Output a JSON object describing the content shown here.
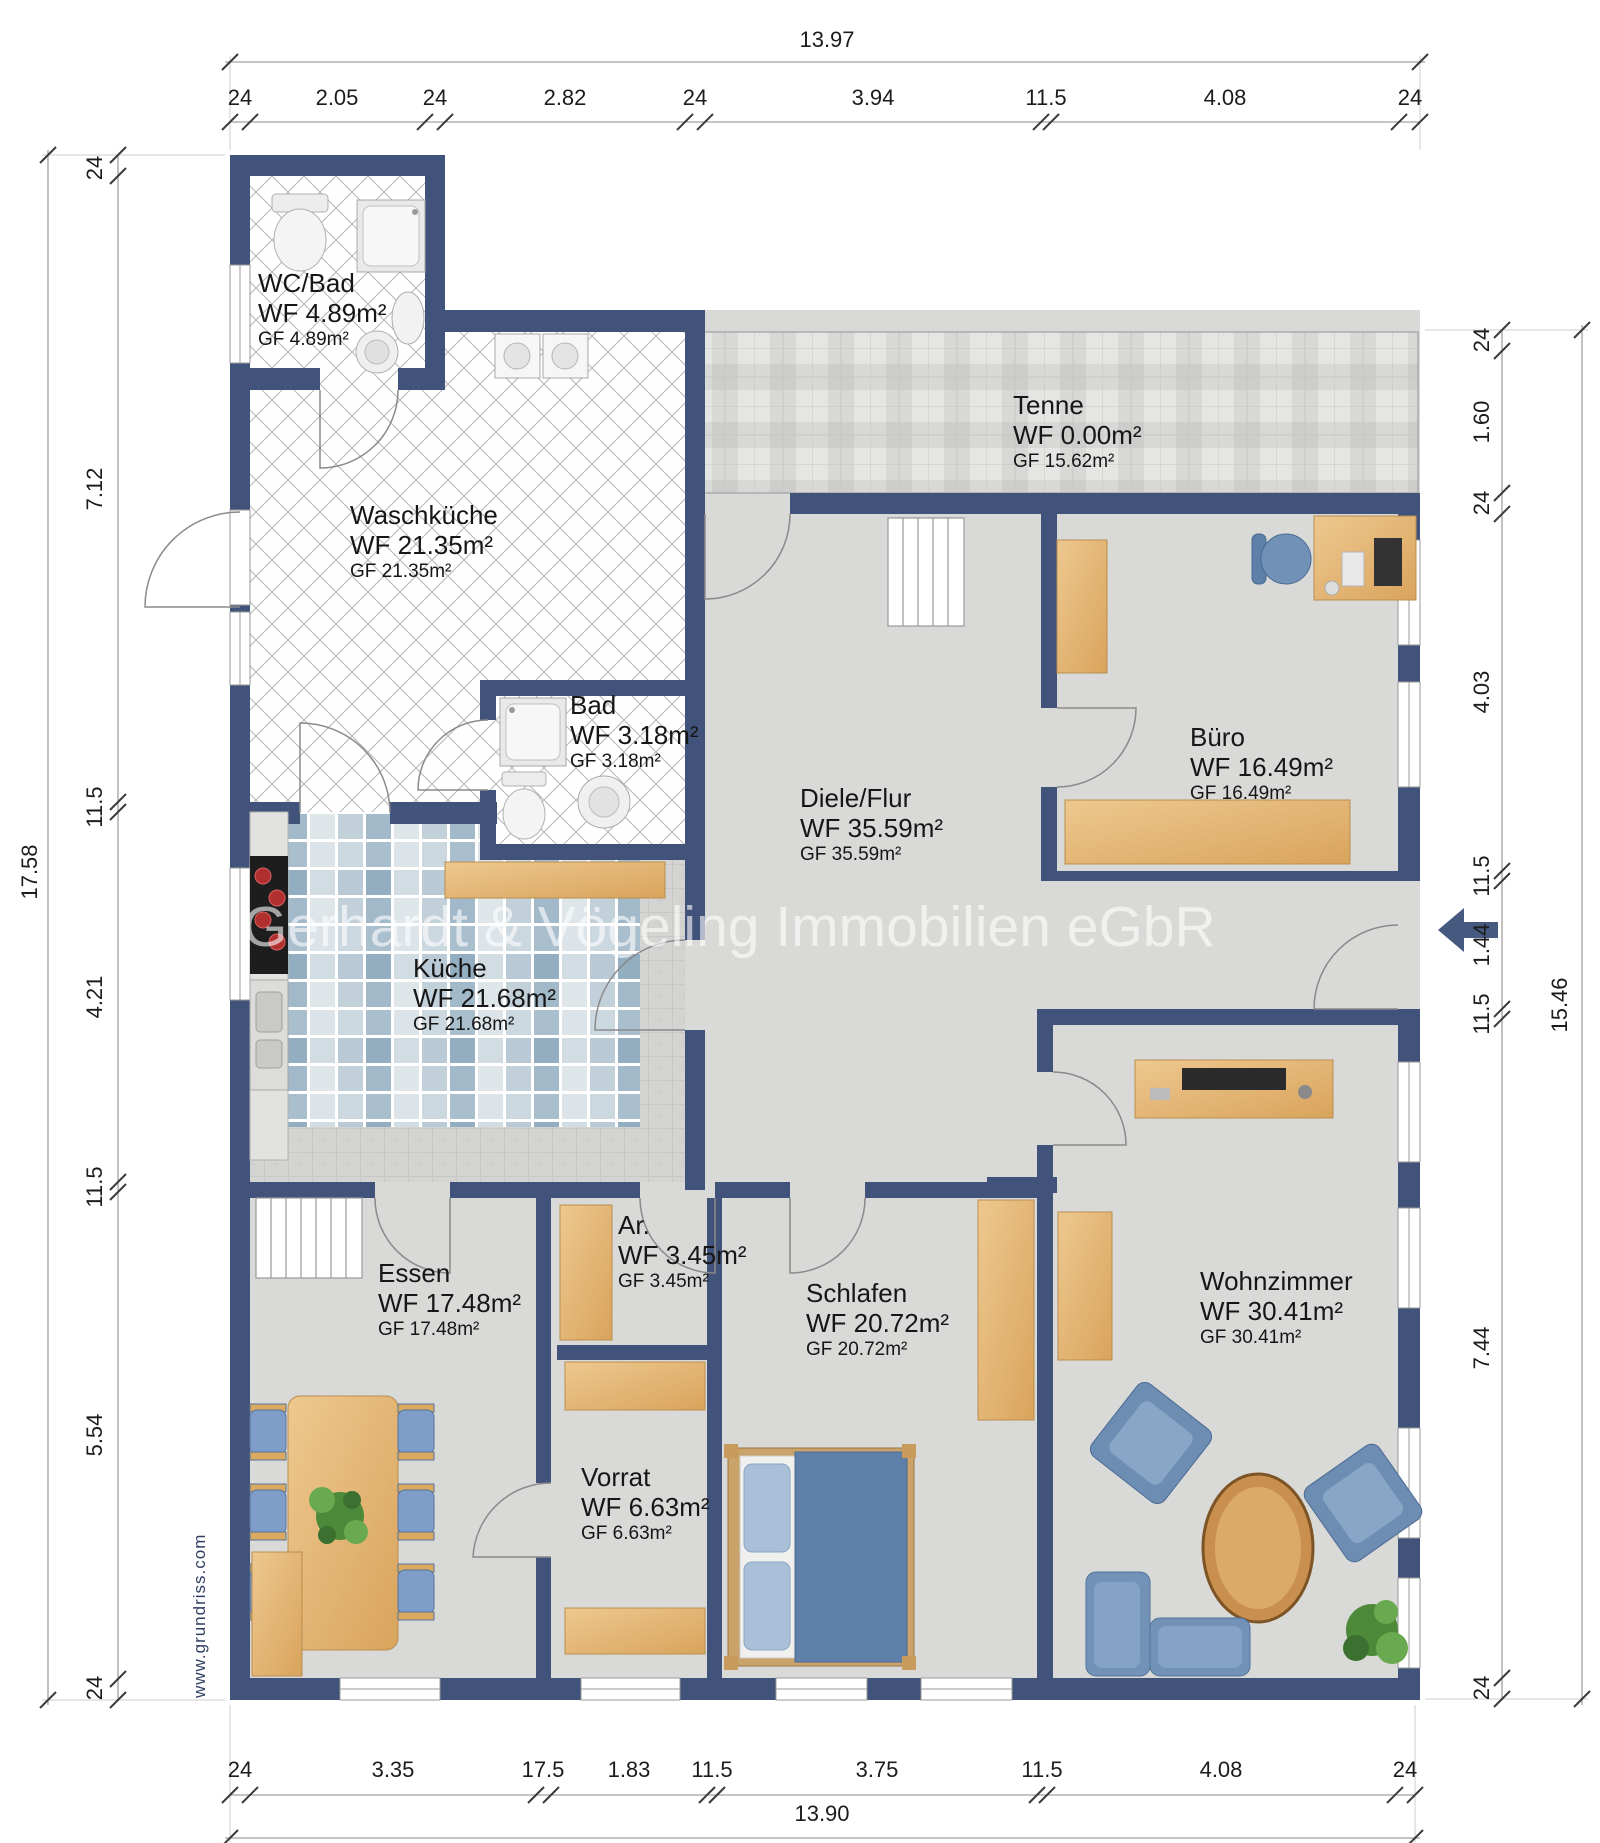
{
  "watermark": "Gerhardt & Vögeling Immobilien eGbR",
  "website_label": "www.grundriss.com",
  "rooms": {
    "wc_bad": {
      "name": "WC/Bad",
      "wf": "WF 4.89m²",
      "gf": "GF 4.89m²"
    },
    "waschkueche": {
      "name": "Waschküche",
      "wf": "WF 21.35m²",
      "gf": "GF 21.35m²"
    },
    "tenne": {
      "name": "Tenne",
      "wf": "WF 0.00m²",
      "gf": "GF 15.62m²"
    },
    "bad": {
      "name": "Bad",
      "wf": "WF 3.18m²",
      "gf": "GF 3.18m²"
    },
    "diele_flur": {
      "name": "Diele/Flur",
      "wf": "WF 35.59m²",
      "gf": "GF 35.59m²"
    },
    "buero": {
      "name": "Büro",
      "wf": "WF 16.49m²",
      "gf": "GF 16.49m²"
    },
    "kueche": {
      "name": "Küche",
      "wf": "WF 21.68m²",
      "gf": "GF 21.68m²"
    },
    "essen": {
      "name": "Essen",
      "wf": "WF 17.48m²",
      "gf": "GF 17.48m²"
    },
    "ar": {
      "name": "Ar.",
      "wf": "WF 3.45m²",
      "gf": "GF 3.45m²"
    },
    "vorrat": {
      "name": "Vorrat",
      "wf": "WF 6.63m²",
      "gf": "GF 6.63m²"
    },
    "schlafen": {
      "name": "Schlafen",
      "wf": "WF 20.72m²",
      "gf": "GF 20.72m²"
    },
    "wohnzimmer": {
      "name": "Wohnzimmer",
      "wf": "WF 30.41m²",
      "gf": "GF 30.41m²"
    }
  },
  "dimensions": {
    "top": {
      "overall": "13.97",
      "segments": [
        "24",
        "2.05",
        "24",
        "2.82",
        "24",
        "3.94",
        "11.5",
        "4.08",
        "24"
      ]
    },
    "bottom": {
      "overall": "13.90",
      "segments": [
        "24",
        "3.35",
        "17.5",
        "1.83",
        "11.5",
        "3.75",
        "11.5",
        "4.08",
        "24"
      ]
    },
    "left": {
      "overall": "17.58",
      "segments": [
        "24",
        "7.12",
        "11.5",
        "4.21",
        "11.5",
        "5.54",
        "24"
      ]
    },
    "right": {
      "overall": "15.46",
      "segments": [
        "24",
        "1.60",
        "24",
        "4.03",
        "11.5",
        "1.44",
        "11.5",
        "7.44",
        "24"
      ]
    }
  },
  "colors": {
    "wall": "#41537a",
    "floor_gray": "#d9d9d7",
    "mosaic_blue": "#a9bece",
    "wood": "#e6bb80",
    "furniture_blue": "#7191b7",
    "entrance_arrow": "#46597f"
  }
}
